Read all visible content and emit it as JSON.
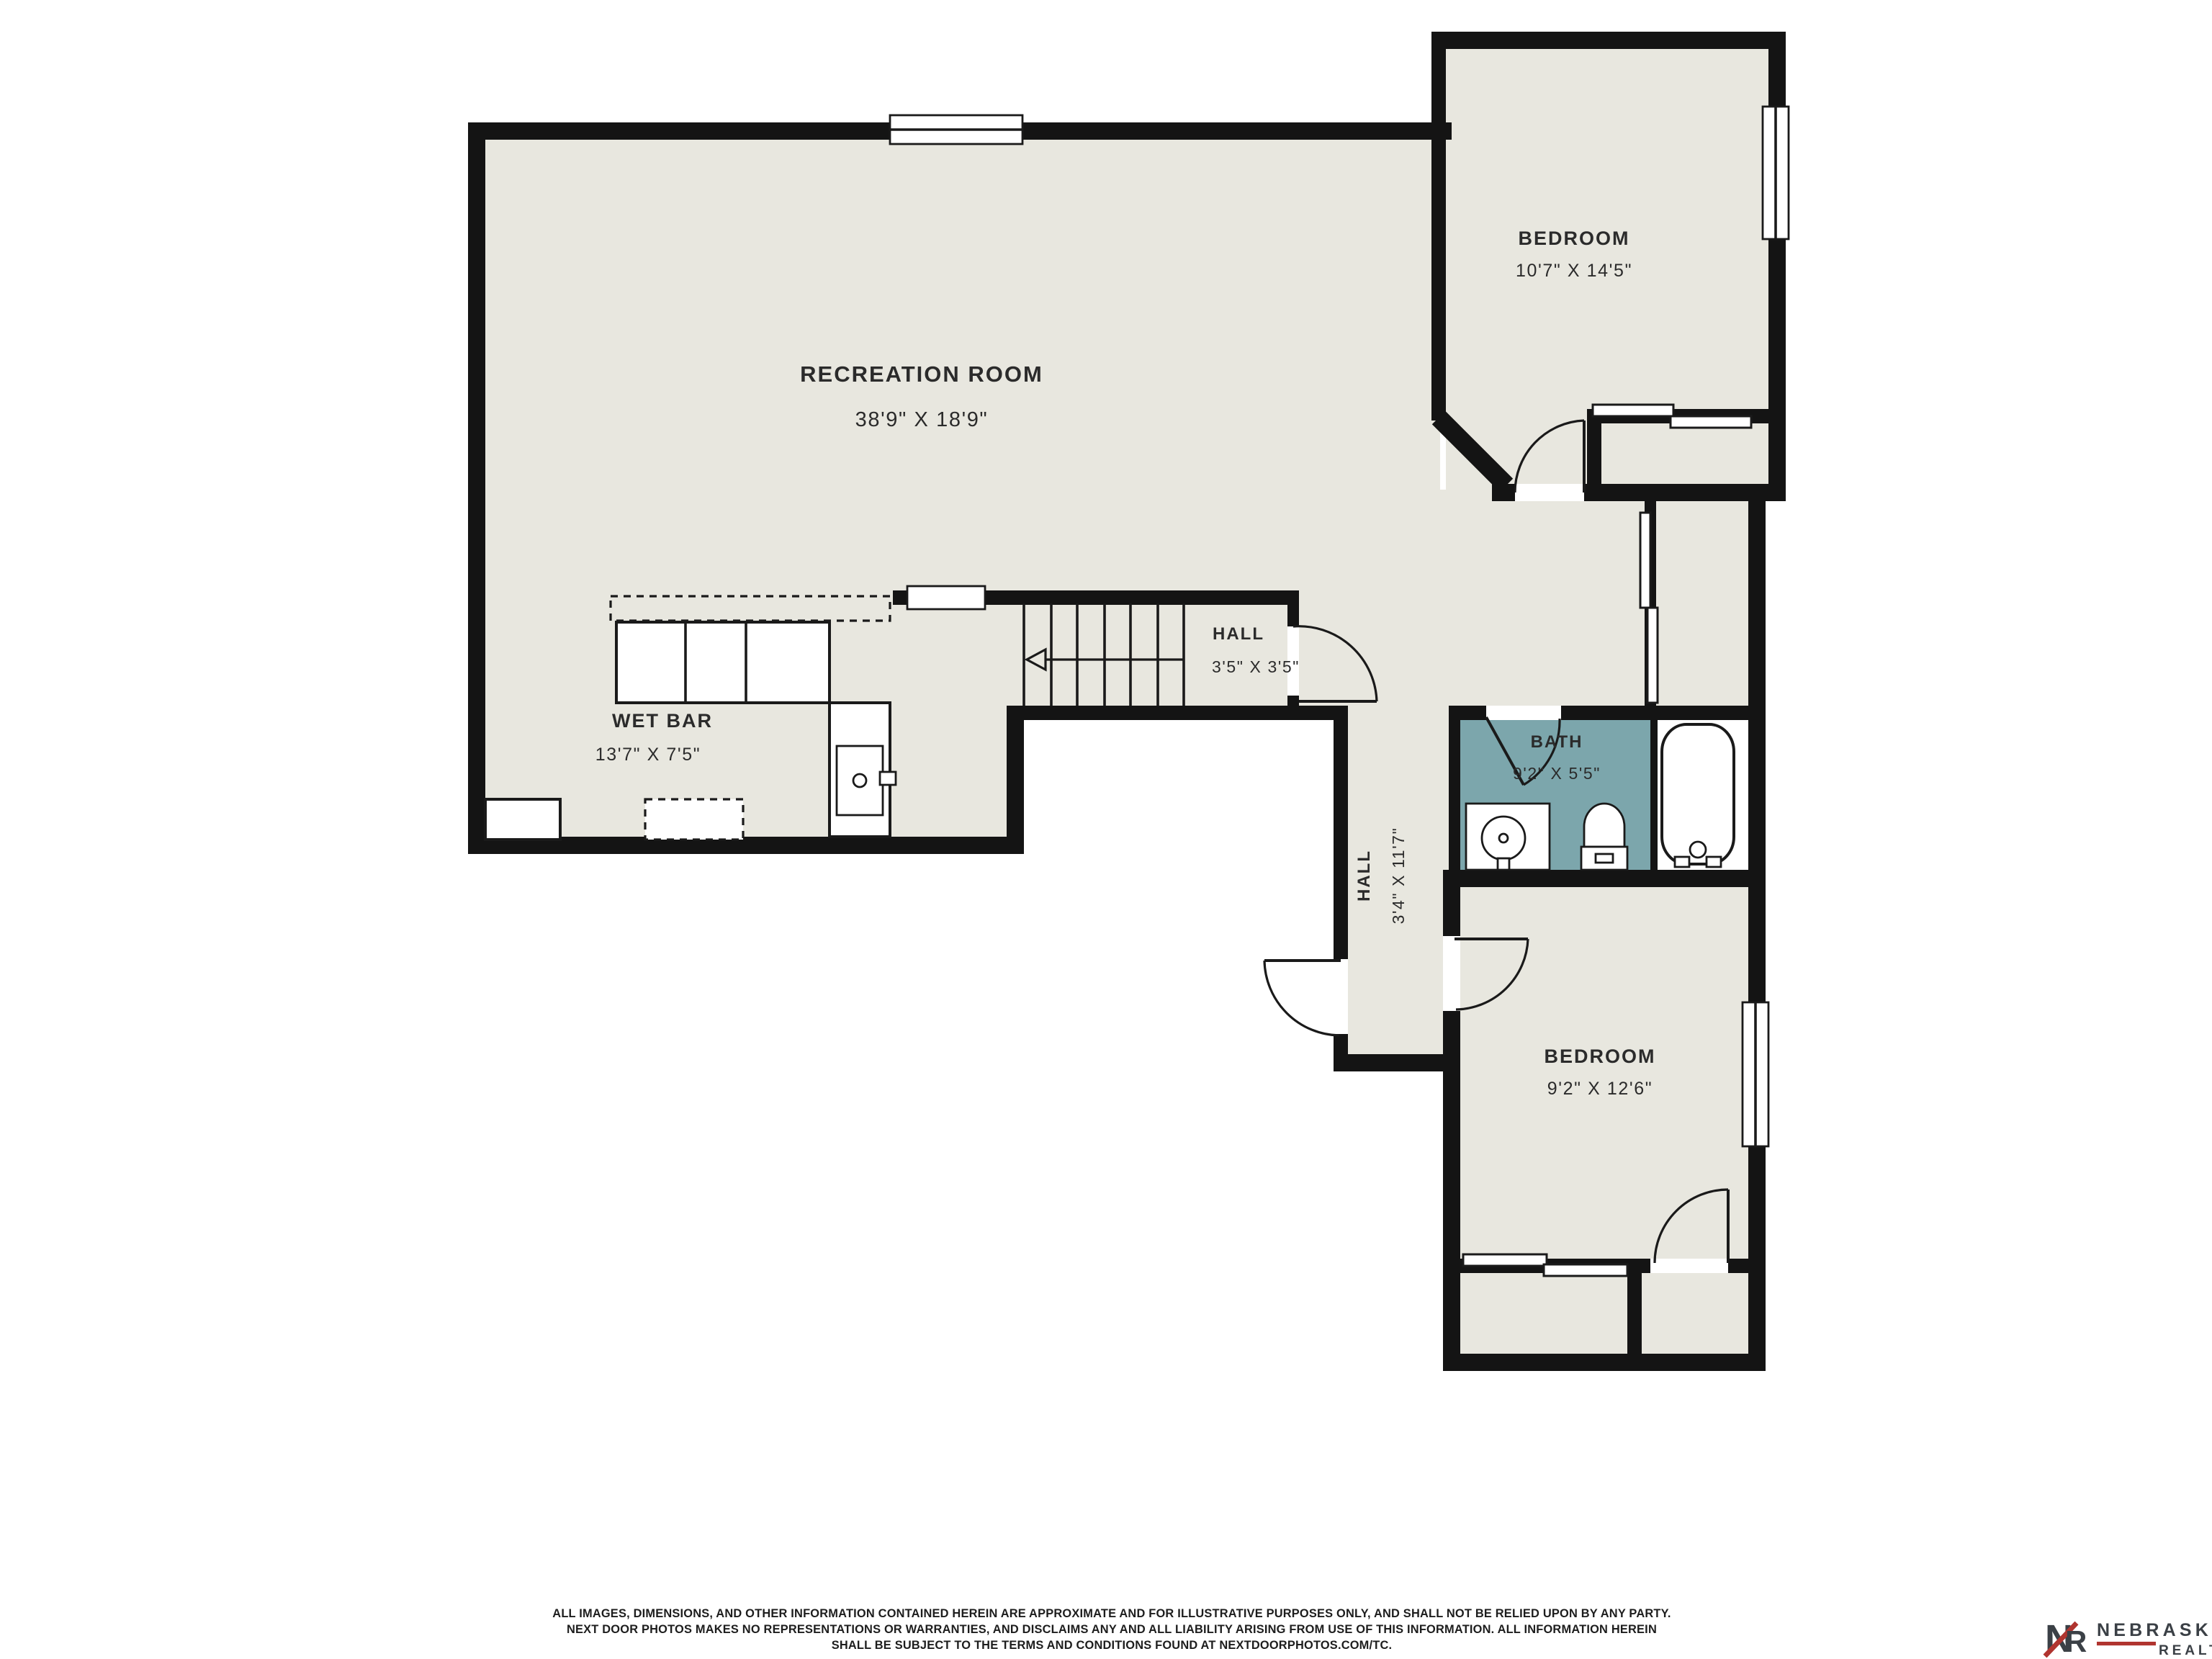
{
  "rooms": {
    "recreation": {
      "label": "RECREATION ROOM",
      "dims": "38'9\" X 18'9\""
    },
    "bedroom_top": {
      "label": "BEDROOM",
      "dims": "10'7\" X 14'5\""
    },
    "hall_small": {
      "label": "HALL",
      "dims": "3'5\" X 3'5\""
    },
    "wet_bar": {
      "label": "WET BAR",
      "dims": "13'7\" X 7'5\""
    },
    "bath": {
      "label": "BATH",
      "dims": "9'2\" X 5'5\""
    },
    "hall_long": {
      "label": "HALL",
      "dims": "3'4\" X 11'7\""
    },
    "bedroom_bottom": {
      "label": "BEDROOM",
      "dims": "9'2\" X 12'6\""
    }
  },
  "footer": {
    "line1": "ALL IMAGES, DIMENSIONS, AND OTHER INFORMATION CONTAINED HEREIN ARE APPROXIMATE AND FOR ILLUSTRATIVE PURPOSES ONLY, AND SHALL NOT BE RELIED UPON BY ANY PARTY.",
    "line2": "NEXT DOOR PHOTOS MAKES NO REPRESENTATIONS OR WARRANTIES, AND DISCLAIMS ANY AND ALL LIABILITY ARISING FROM USE OF THIS INFORMATION. ALL INFORMATION HEREIN",
    "line3": "SHALL BE SUBJECT TO THE TERMS AND CONDITIONS FOUND AT NEXTDOORPHOTOS.COM/TC."
  },
  "logo": {
    "letter_n": "N",
    "letter_r": "R",
    "name": "NEBRASKA",
    "subtitle": "REALTY"
  },
  "colors": {
    "background": "#ffffff",
    "floor": "#e8e7df",
    "bath_floor": "#7ca6ac",
    "wall": "#141414",
    "text": "#2b2b2b",
    "logo_dark": "#3b4046",
    "logo_red": "#b0342f"
  }
}
